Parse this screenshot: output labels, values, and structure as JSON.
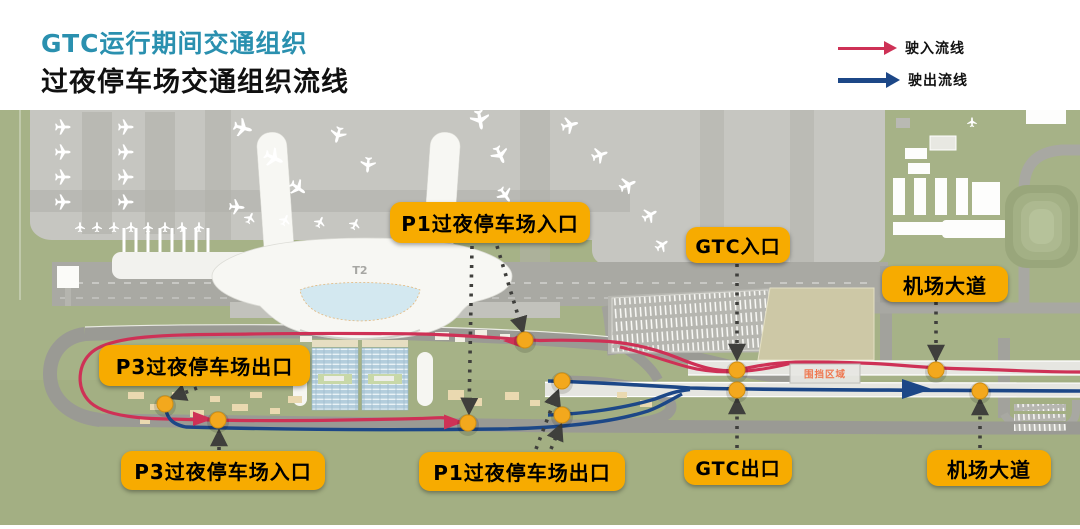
{
  "header": {
    "title": "GTC运行期间交通组织",
    "subtitle": "过夜停车场交通组织流线",
    "title_color": "#2a90af"
  },
  "legend": {
    "inbound": {
      "label": "驶入流线",
      "color": "#ce3156"
    },
    "outbound": {
      "label": "驶出流线",
      "color": "#1c4787"
    }
  },
  "map": {
    "terminal": "T2",
    "enclosure": "围挡区域",
    "labels": {
      "p1_entrance": "P1过夜停车场入口",
      "gtc_entrance": "GTC入口",
      "avenue_top": "机场大道",
      "p3_exit": "P3过夜停车场出口",
      "p3_entrance": "P3过夜停车场入口",
      "p1_exit": "P1过夜停车场出口",
      "gtc_exit": "GTC出口",
      "avenue_bottom": "机场大道"
    },
    "colors": {
      "callout_bg": "#F7AB00",
      "inbound_line": "#ce3156",
      "outbound_line": "#1c4787",
      "marker_dot": "#F3A81D",
      "enclosure_text": "#ef7850"
    }
  }
}
